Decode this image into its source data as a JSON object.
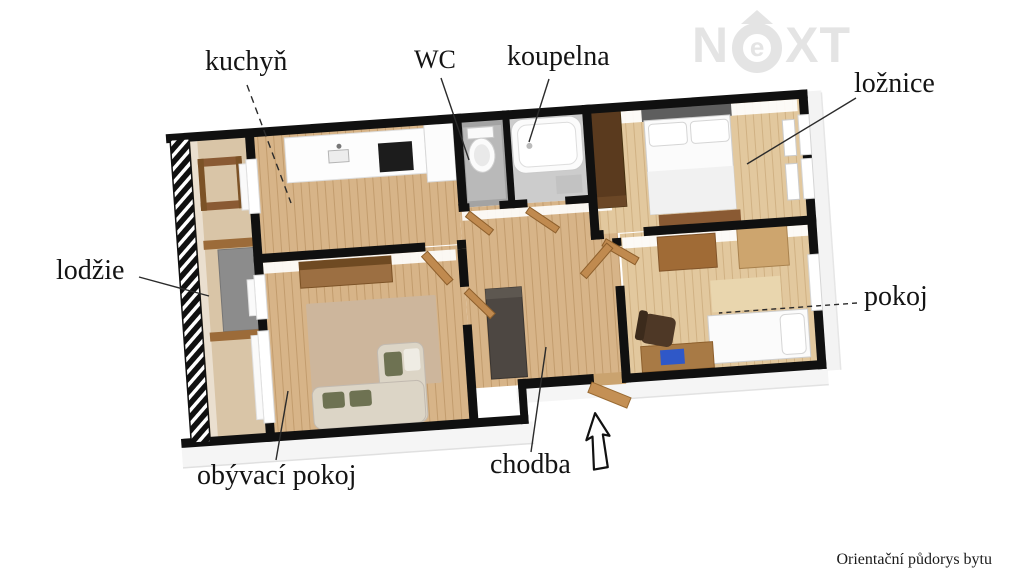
{
  "attribution": {
    "text": "Orientační půdorys bytu"
  },
  "logo": {
    "brand": "NEXT",
    "part_n": "N",
    "part_e": "e",
    "part_xt": "XT",
    "color": "#e4e4e4",
    "roof_icon": "roof-triangle"
  },
  "entrance": {
    "arrow_icon": "arrow-up",
    "meaning": "apartment entrance"
  },
  "floor_plan": {
    "type": "3d-apartment-floor-plan",
    "wall_color": "#101010",
    "floor_wood_color": "#d7b488",
    "floor_wood_light_color": "#e2c89e",
    "loggia_floor_color": "#d9c5a7",
    "tile_gray_color": "#a3a3a3",
    "rooms": [
      {
        "id": "kuchyn",
        "label": "kuchyň",
        "leader": "dashed",
        "furniture": [
          "kitchen-counter",
          "cooktop",
          "sink",
          "fridge"
        ]
      },
      {
        "id": "wc",
        "label": "WC",
        "leader": "solid",
        "furniture": [
          "toilet"
        ]
      },
      {
        "id": "koupelna",
        "label": "koupelna",
        "leader": "solid",
        "furniture": [
          "bathtub"
        ]
      },
      {
        "id": "loznice",
        "label": "ložnice",
        "leader": "solid",
        "furniture": [
          "double-bed",
          "wardrobe",
          "bench",
          "window",
          "radiator"
        ]
      },
      {
        "id": "lodzie",
        "label": "lodžie",
        "leader": "solid",
        "furniture": [
          "railing",
          "table",
          "panel"
        ]
      },
      {
        "id": "pokoj",
        "label": "pokoj",
        "leader": "dashed",
        "furniture": [
          "dresser",
          "chest",
          "single-bed",
          "desk",
          "laptop",
          "office-chair",
          "rug"
        ]
      },
      {
        "id": "obyvaci_pokoj",
        "label": "obývací pokoj",
        "leader": "solid",
        "furniture": [
          "tv-sideboard",
          "corner-sofa",
          "pillows",
          "rug"
        ]
      },
      {
        "id": "chodba",
        "label": "chodba",
        "leader": "solid",
        "furniture": [
          "wardrobe",
          "open-doors",
          "entrance-door"
        ]
      }
    ]
  }
}
